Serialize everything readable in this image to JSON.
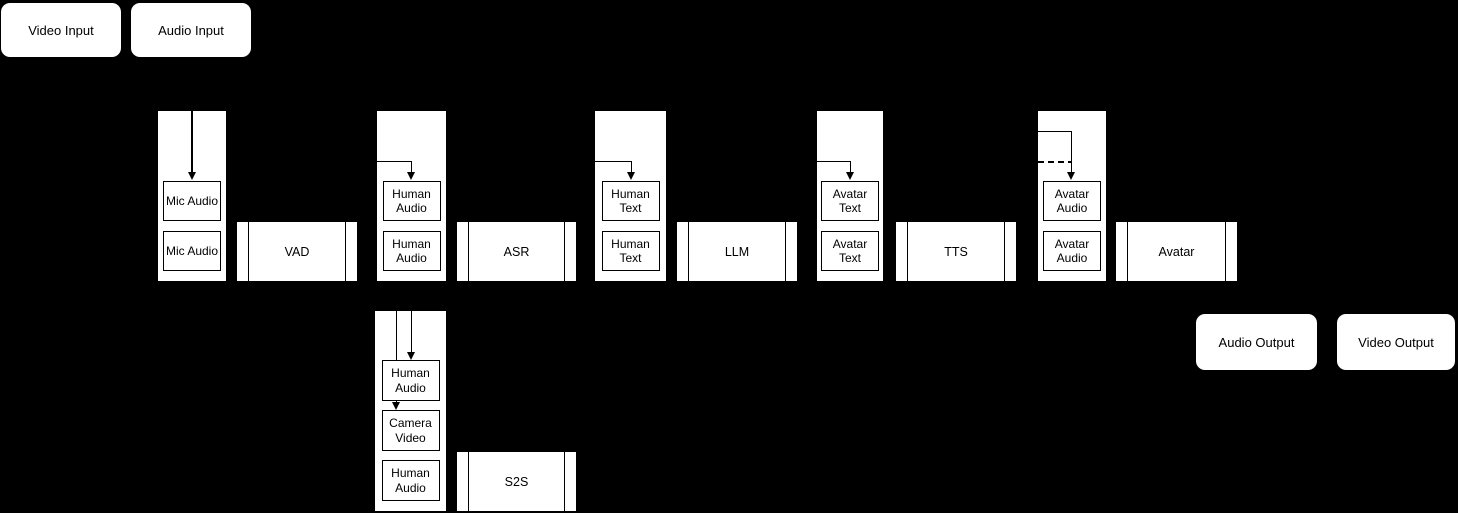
{
  "diagram": {
    "colors": {
      "background": "#000000",
      "node_fill": "#ffffff",
      "stroke": "#000000"
    },
    "inputs": {
      "video": {
        "label": "Video Input"
      },
      "audio": {
        "label": "Audio Input"
      }
    },
    "outputs": {
      "audio": {
        "label": "Audio Output"
      },
      "video": {
        "label": "Video Output"
      }
    },
    "queues": [
      {
        "name": "mic-audio-queue",
        "items": [
          "Mic Audio",
          "Mic Audio"
        ]
      },
      {
        "name": "human-audio-queue",
        "items": [
          "Human Audio",
          "Human Audio"
        ]
      },
      {
        "name": "human-text-queue",
        "items": [
          "Human Text",
          "Human Text"
        ]
      },
      {
        "name": "avatar-text-queue",
        "items": [
          "Avatar Text",
          "Avatar Text"
        ]
      },
      {
        "name": "avatar-audio-queue",
        "items": [
          "Avatar Audio",
          "Avatar Audio"
        ]
      },
      {
        "name": "s2s-input-queue",
        "items": [
          "Human Audio",
          "Camera Video",
          "Human Audio"
        ]
      }
    ],
    "processes": [
      {
        "name": "vad",
        "label": "VAD"
      },
      {
        "name": "asr",
        "label": "ASR"
      },
      {
        "name": "llm",
        "label": "LLM"
      },
      {
        "name": "tts",
        "label": "TTS"
      },
      {
        "name": "avatar",
        "label": "Avatar"
      },
      {
        "name": "s2s",
        "label": "S2S"
      }
    ]
  }
}
